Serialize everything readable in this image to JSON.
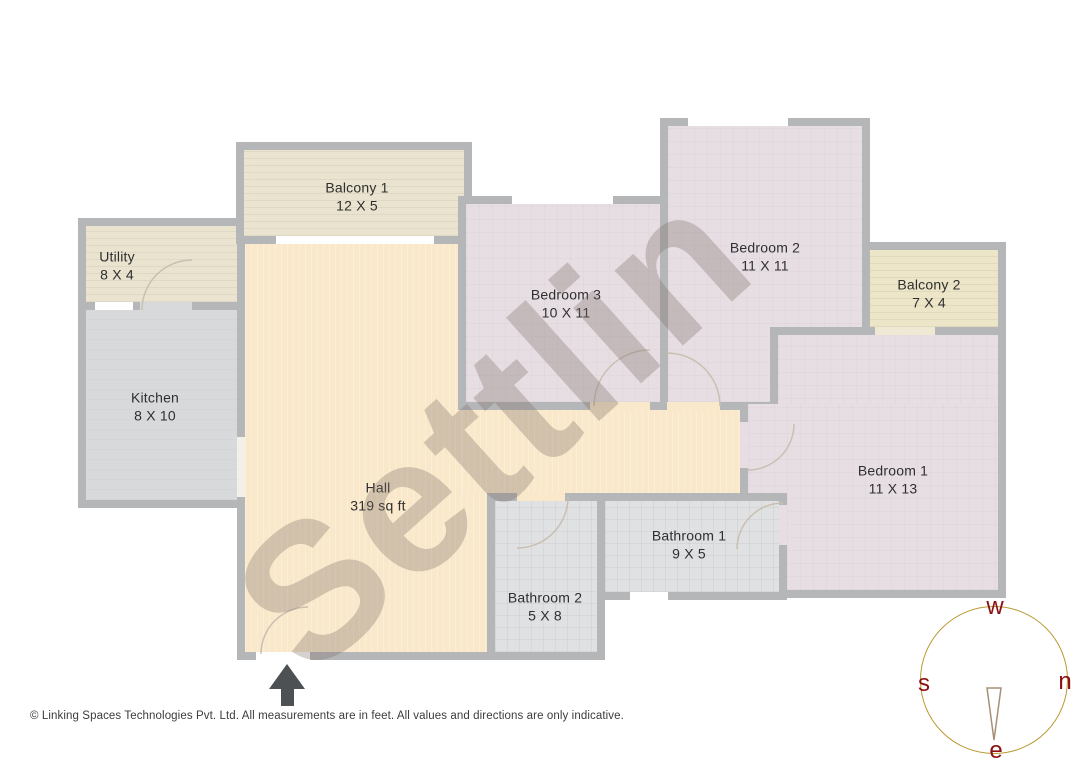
{
  "plan": {
    "watermark": "Settlin",
    "rooms": [
      {
        "name": "Balcony 1",
        "dims": "12 X 5"
      },
      {
        "name": "Utility",
        "dims": "8 X 4"
      },
      {
        "name": "Kitchen",
        "dims": "8 X 10"
      },
      {
        "name": "Hall",
        "dims": "319 sq ft"
      },
      {
        "name": "Bedroom 3",
        "dims": "10 X 11"
      },
      {
        "name": "Bedroom 2",
        "dims": "11 X 11"
      },
      {
        "name": "Balcony 2",
        "dims": "7 X 4"
      },
      {
        "name": "Bedroom 1",
        "dims": "11 X 13"
      },
      {
        "name": "Bathroom 1",
        "dims": "9 X 5"
      },
      {
        "name": "Bathroom 2",
        "dims": "5 X 8"
      }
    ]
  },
  "compass": {
    "top": "w",
    "left": "s",
    "right": "n",
    "bottom": "e"
  },
  "footer": {
    "text": "© Linking Spaces Technologies Pvt. Ltd. All measurements are in feet. All values and directions are only indicative."
  },
  "colors": {
    "wall": "#b4b6b8",
    "hall": "#f9e8ca",
    "bed": "#e7dee3",
    "balc": "#eae3cf",
    "balc2": "#ece5c7",
    "kitchen": "#d7d9db",
    "bath": "#dfe1e3",
    "label": "#2f2f2f",
    "red": "#8b1111",
    "ring": "#b89a33",
    "arrow": "#4d5154",
    "watermark": "rgba(124,112,104,0.32)"
  }
}
